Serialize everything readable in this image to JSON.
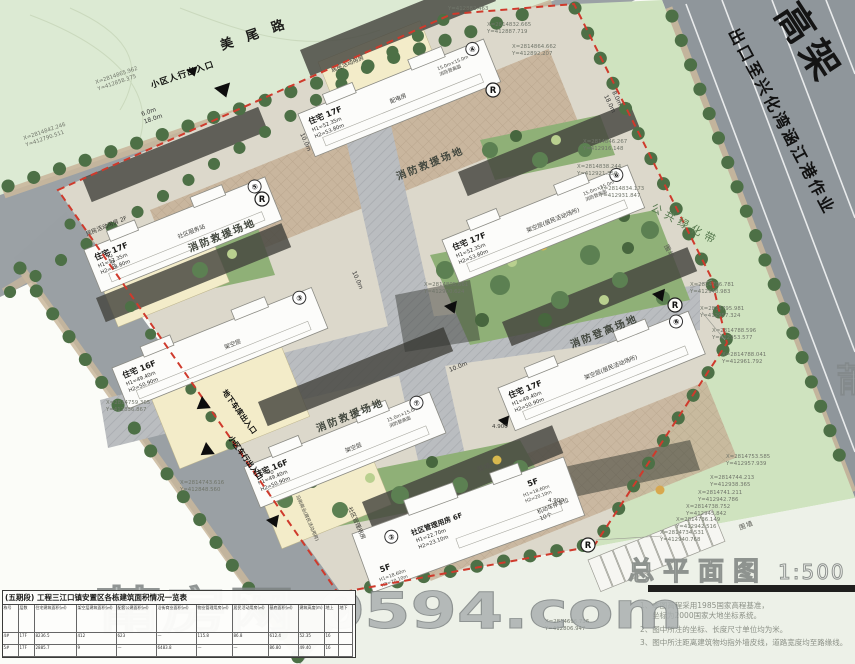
{
  "title_block": {
    "title": "总平面图",
    "scale": "1:500",
    "watermark": "莆房网 0594.com",
    "watermark_partial": "莆",
    "notes": [
      "1、本图高程采用1985国家高程基准，",
      "坐标为2000国家大地坐标系统。",
      "2、图中所注的坐标、长度尺寸单位均为米。",
      "3、图中所注距离建筑物均指外墙皮线，道路宽度均至路缘线。"
    ]
  },
  "roads": {
    "mei_wei_road": "美尾路",
    "highway": "高架",
    "highway_sub": "出口至兴化湾涵江港作业",
    "top_w1": "6.0m",
    "top_w2": "18.0m",
    "right_w1": "8.0m",
    "right_w2": "18.0m"
  },
  "entrances": {
    "pedestrian": "小区人行出入口",
    "vehicle": "小区车行出入口",
    "garage": "地下车库出入口"
  },
  "areas": {
    "public_green": "公共绿化带",
    "wall": "围墙",
    "fire_rescue": "消防救援场地",
    "fire_climb_site": "消防登高场地",
    "parking": "机动车停车位",
    "parking_count": "10个",
    "community_podium": "社区管理用房",
    "street_shop": "沿街商业(居民活动用房)"
  },
  "buildings": [
    {
      "circle": "④",
      "label": "住宅 17F",
      "h1": "H1=52.35m",
      "h2": "H2=53.80m",
      "note": "配电房",
      "podium": "居民活动用房",
      "climb": "15.0m×15.0m",
      "climb2": "消防登高面"
    },
    {
      "circle": "⑤",
      "label": "住宅 17F",
      "h1": "H1=52.35m",
      "h2": "H2=53.80m",
      "note": "社区服务站",
      "podium": "居民活动用房 2F"
    },
    {
      "circle": "③",
      "label": "住宅 16F",
      "h1": "H1=49.40m",
      "h2": "H2=50.90m",
      "note": "架空层"
    },
    {
      "circle": "⑥",
      "label": "住宅 17F",
      "h1": "H1=52.35m",
      "h2": "H2=53.80m",
      "note": "架空层(居民活动场所)",
      "climb": "15.0m×15.0m",
      "climb2": "消防登高面"
    },
    {
      "circle": "⑧",
      "label": "住宅 17F",
      "h1": "H1=49.40m",
      "h2": "H2=50.90m",
      "note": "架空层(居民活动场所)"
    },
    {
      "circle": "⑦",
      "label": "住宅 16F",
      "h1": "H1=49.40m",
      "h2": "H2=50.90m",
      "note": "架空层",
      "climb": "15.0m×15.0m",
      "climb2": "消防登高面"
    },
    {
      "circle": "②",
      "label": "社区管理用房 6F",
      "h1": "H1=22.70m",
      "h2": "H2=23.10m",
      "wing": "5F",
      "wing_h1": "H1=18.60m",
      "wing_h2": "H2=20.10m"
    }
  ],
  "markers": {
    "r": "R",
    "spot_level": "4.900",
    "w10": "10.0m",
    "w12": "12.0m"
  },
  "coords": [
    {
      "x": "X=2814865.962",
      "y": "Y=412858.375"
    },
    {
      "x": "X=2814842.246",
      "y": "Y=412790.511"
    },
    {
      "x": "",
      "y": "Y=412882.463"
    },
    {
      "x": "X=2814832.665",
      "y": "Y=412887.719"
    },
    {
      "x": "X=2814864.662",
      "y": "Y=412892.207"
    },
    {
      "x": "X=2814846.267",
      "y": "Y=412916.148"
    },
    {
      "x": "X=2814838.244",
      "y": "Y=412921.350"
    },
    {
      "x": "X=2814834.173",
      "y": "Y=412931.847"
    },
    {
      "x": "X=2814796.781",
      "y": "Y=412948.983"
    },
    {
      "x": "X=2814795.981",
      "y": "Y=412957.324"
    },
    {
      "x": "X=2814788.596",
      "y": "Y=412953.577"
    },
    {
      "x": "X=2814788.041",
      "y": "Y=412961.792"
    },
    {
      "x": "X=2814753.585",
      "y": "Y=412957.939"
    },
    {
      "x": "X=2814744.213",
      "y": "Y=412938.365"
    },
    {
      "x": "X=2814741.211",
      "y": "Y=412942.786"
    },
    {
      "x": "X=2814738.752",
      "y": "Y=412945.842"
    },
    {
      "x": "X=2814736.149",
      "y": "Y=412942.516"
    },
    {
      "x": "X=2814734.531",
      "y": "Y=412940.768"
    },
    {
      "x": "X=2814696.736",
      "y": "Y=412806.947"
    },
    {
      "x": "X=2814805.661",
      "y": "Y=412900.624"
    },
    {
      "x": "X=2814759.365",
      "y": "Y=412836.867"
    },
    {
      "x": "X=2814743.616",
      "y": "Y=412848.560"
    }
  ],
  "table": {
    "title": "(五期段) 工程三江口镇安置区各栋建筑面积情况一览表",
    "headers": [
      "栋号",
      "层数",
      "住宅建筑面积(㎡)",
      "架空层建筑面积(㎡)",
      "配套公建面积(㎡)",
      "沿街商业面积(㎡)",
      "物业管理用房(㎡)",
      "居民活动用房(㎡)",
      "基底面积(㎡)",
      "建筑高度(m)",
      "地上",
      "地下"
    ],
    "rows": [
      [
        "4#",
        "17F",
        "8236.5",
        "412",
        "623",
        "—",
        "115.8",
        "86.8",
        "612.4",
        "52.35",
        "16",
        ""
      ],
      [
        "5#",
        "17F",
        "2885.7",
        "9",
        "—",
        "6483.8",
        "—",
        "—",
        "86.80",
        "49.40",
        "16",
        ""
      ]
    ]
  }
}
